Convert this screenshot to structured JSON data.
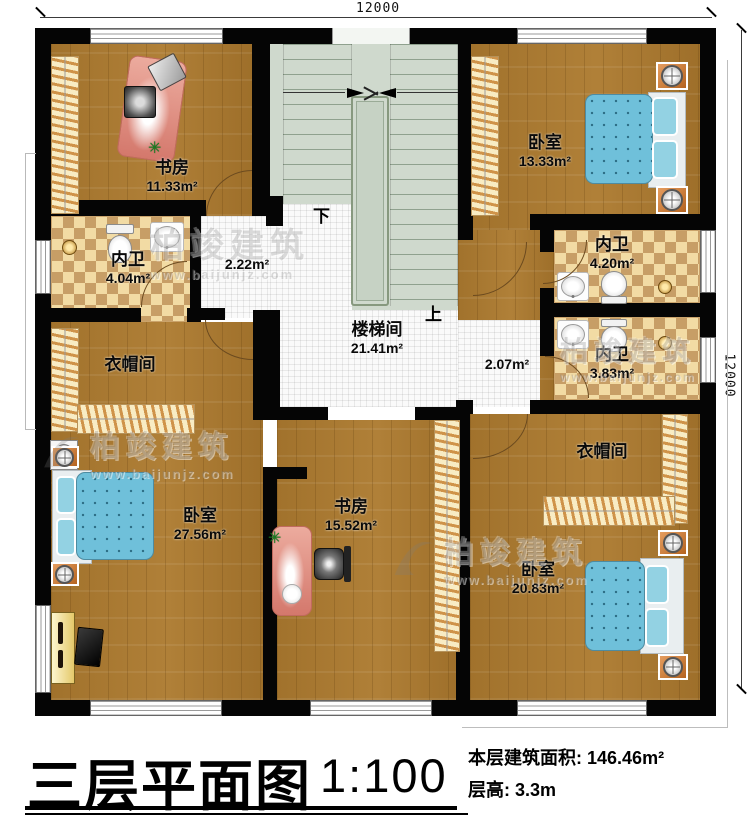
{
  "plan": {
    "dimension_top": "12000",
    "dimension_right": "12000",
    "stairs": {
      "down": "下",
      "up": "上"
    }
  },
  "rooms": {
    "study_top": {
      "name": "书房",
      "area": "11.33m²"
    },
    "bedroom_tr": {
      "name": "卧室",
      "area": "13.33m²"
    },
    "bath_left": {
      "name": "内卫",
      "area": "4.04m²"
    },
    "hall_left": {
      "area": "2.22m²"
    },
    "stairwell": {
      "name": "楼梯间",
      "area": "21.41m²"
    },
    "hall_right": {
      "area": "2.07m²"
    },
    "bath_rt": {
      "name": "内卫",
      "area": "4.20m²"
    },
    "bath_rm": {
      "name": "内卫",
      "area": "3.83m²"
    },
    "closet_left": {
      "name": "衣帽间"
    },
    "bedroom_bl": {
      "name": "卧室",
      "area": "27.56m²"
    },
    "study_bottom": {
      "name": "书房",
      "area": "15.52m²"
    },
    "closet_right": {
      "name": "衣帽间"
    },
    "bedroom_br": {
      "name": "卧室",
      "area": "20.83m²"
    }
  },
  "watermark": {
    "brand": "柏竣建筑",
    "url": "www.baijunjz.com"
  },
  "title_block": {
    "title": "三层平面图",
    "scale": "1:100",
    "area_label": "本层建筑面积:",
    "area_value": "146.46m²",
    "floor_height_label": "层高:",
    "floor_height_value": "3.3m"
  }
}
